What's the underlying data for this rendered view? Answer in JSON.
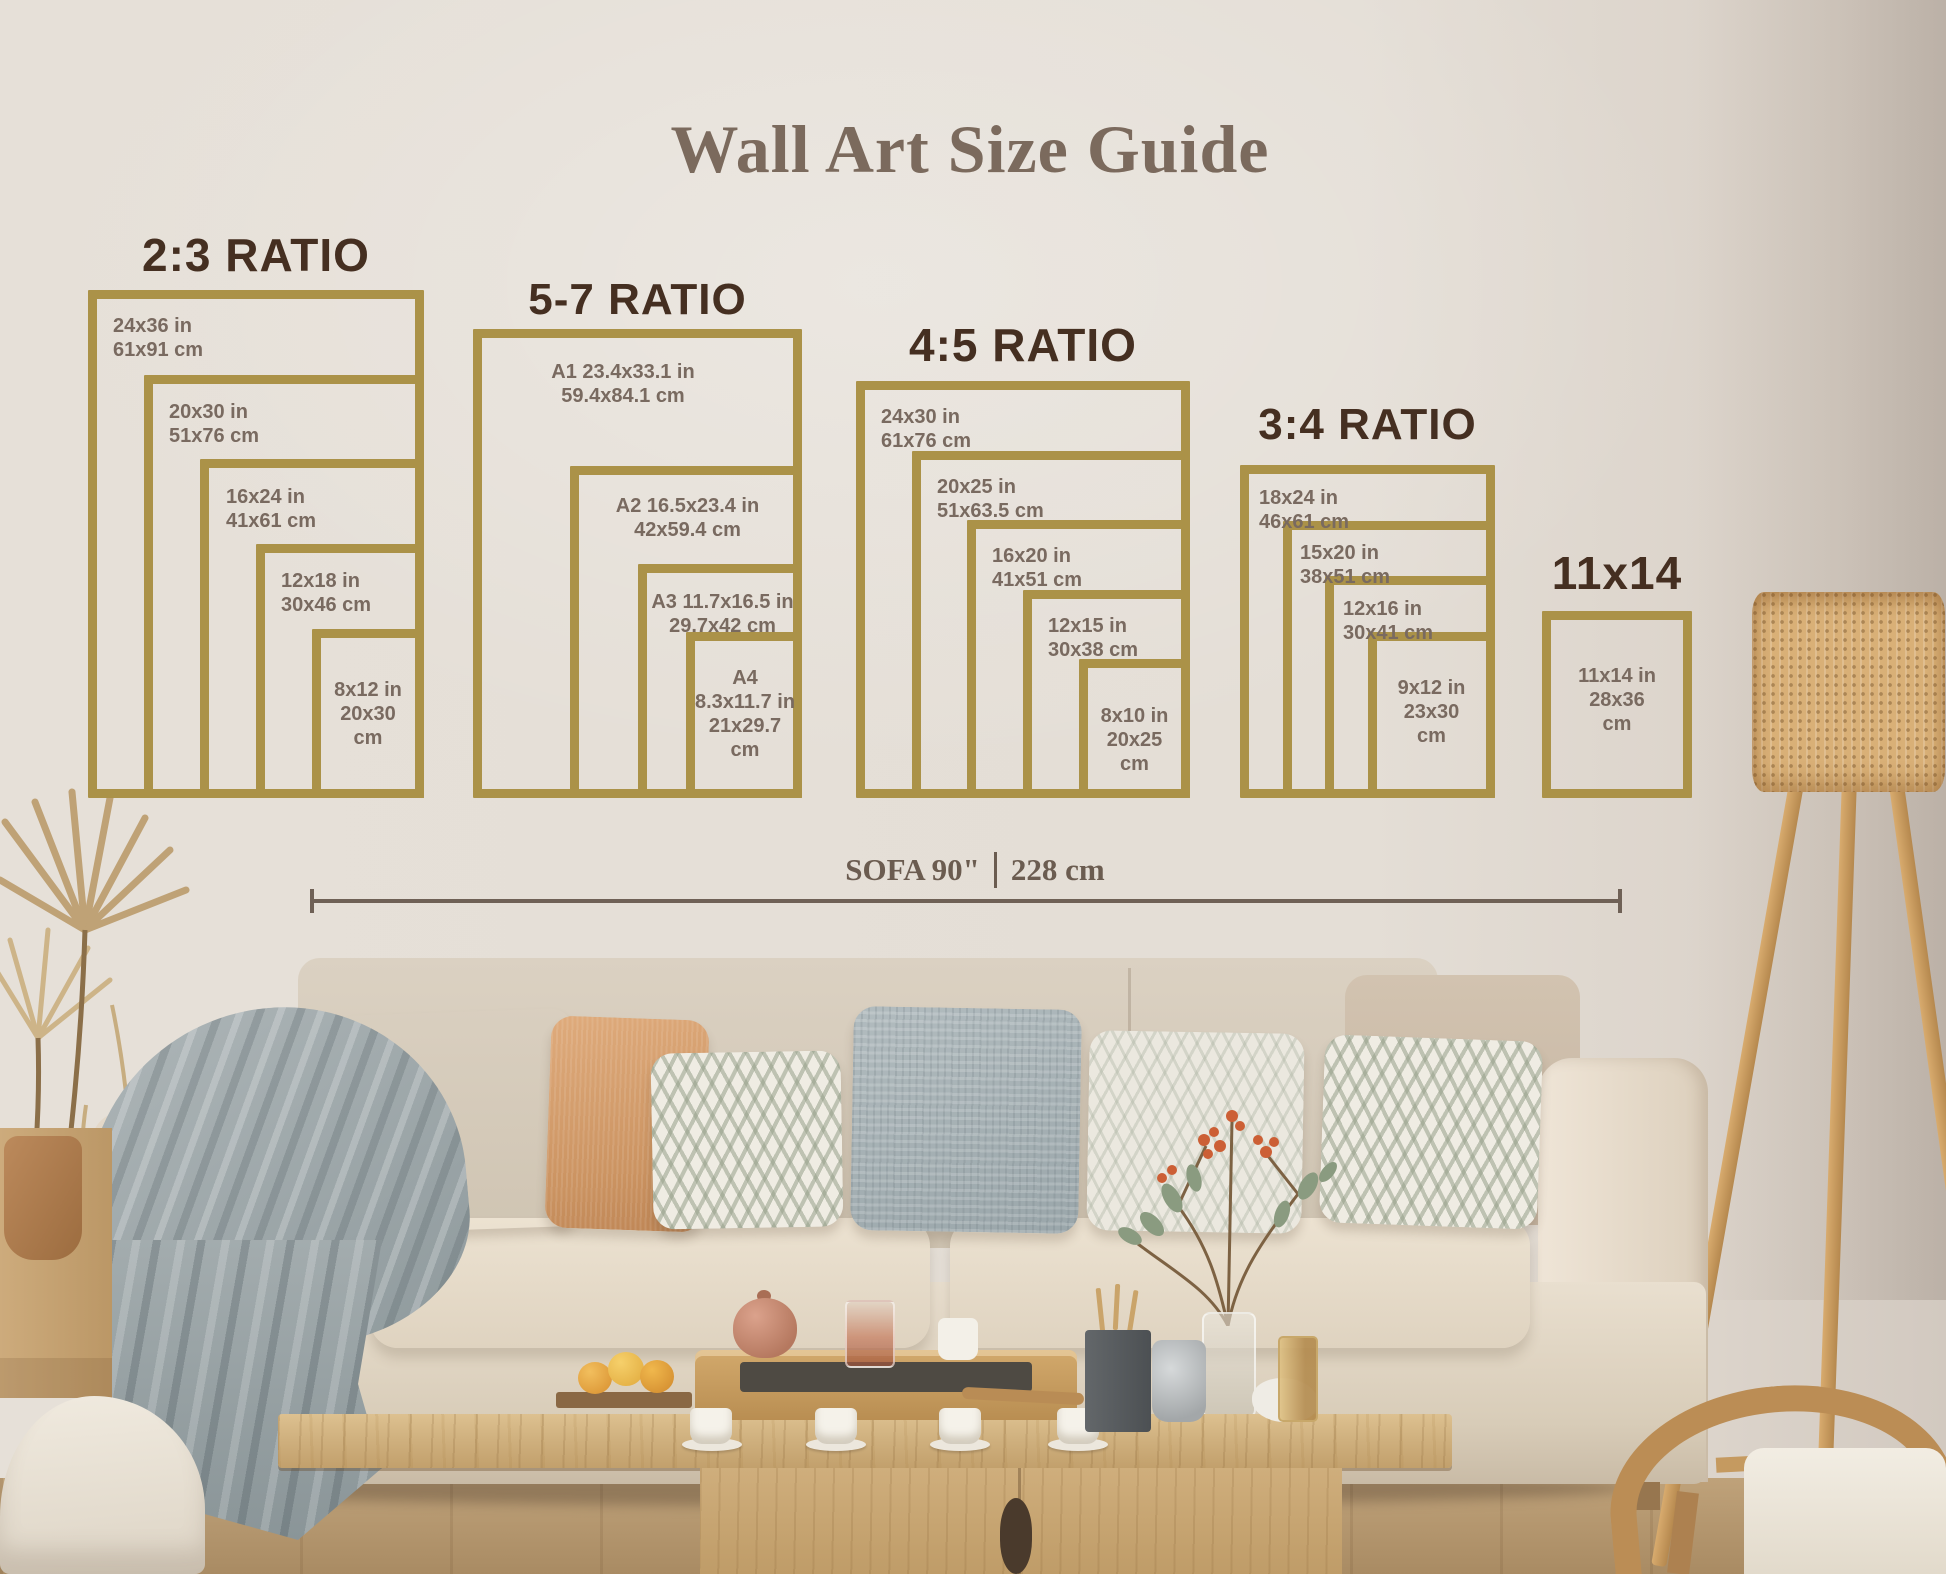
{
  "title": "Wall Art Size Guide",
  "groups": [
    {
      "title": "2:3 RATIO",
      "sizes": [
        "24x36 in\n61x91 cm",
        "20x30 in\n51x76 cm",
        "16x24 in\n41x61 cm",
        "12x18 in\n30x46 cm",
        "8x12 in\n20x30\ncm"
      ]
    },
    {
      "title": "5-7 RATIO",
      "sizes": [
        "A1 23.4x33.1 in\n59.4x84.1 cm",
        "A2 16.5x23.4 in\n42x59.4 cm",
        "A3 11.7x16.5 in\n29.7x42 cm",
        "A4\n8.3x11.7 in\n21x29.7\ncm"
      ]
    },
    {
      "title": "4:5 RATIO",
      "sizes": [
        "24x30 in\n61x76 cm",
        "20x25 in\n51x63.5 cm",
        "16x20 in\n41x51 cm",
        "12x15 in\n30x38 cm",
        "8x10 in\n20x25\ncm"
      ]
    },
    {
      "title": "3:4 RATIO",
      "sizes": [
        "18x24 in\n46x61 cm",
        "15x20 in\n38x51 cm",
        "12x16 in\n30x41 cm",
        "9x12 in\n23x30\ncm"
      ]
    },
    {
      "title": "11x14",
      "sizes": [
        "11x14 in\n28x36\ncm"
      ]
    }
  ],
  "sofa_scale": {
    "imperial": "SOFA 90\"",
    "metric": "228 cm"
  },
  "colors": {
    "frame_gold": "#ab9248",
    "ratio_title": "#452f21",
    "size_label": "#796a60",
    "serif_text": "#6b5c50"
  }
}
